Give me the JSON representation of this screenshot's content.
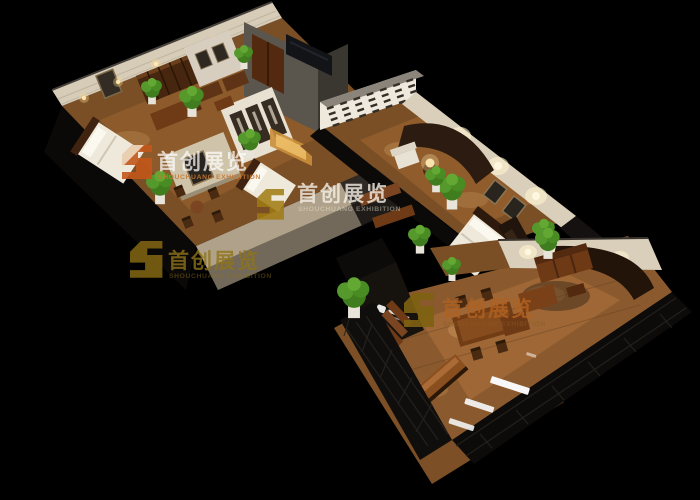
{
  "scene": {
    "type": "3d-birdseye-interior-render",
    "description": "Bird's-eye 3D rendering of a zigzag wooden furniture exhibition showroom (bedroom, study, living and dining displays) floating on a black background",
    "background_color": "#000000",
    "palette": {
      "floor_wood": "#8a5a2e",
      "floor_wood_light": "#b87840",
      "wall_cream": "#d9cfba",
      "wall_taupe": "#b0a28a",
      "wall_gray": "#57524b",
      "wall_dark": "#16120e",
      "lattice_black": "#0d0b0a",
      "furniture_brown": "#6e3a16",
      "bedding_white": "#efe9dc",
      "plant_green": "#4a8c24",
      "light_warm": "#ffd98a",
      "sign_white": "#f5f5f5"
    },
    "rooms": [
      {
        "name": "bedroom-study-suite",
        "position": "top-left",
        "furnishings": [
          "double-bed",
          "bookcase",
          "writing-desk",
          "armchairs",
          "tea-table",
          "wardrobe-niche-display",
          "second-bed",
          "potted-plants",
          "framed-art",
          "wall-sconces"
        ]
      },
      {
        "name": "living-bedroom-suite",
        "position": "center",
        "furnishings": [
          "drawer-display-wall",
          "curved-feature-wall",
          "white-armchair",
          "table-lamp",
          "wood-benches",
          "double-bed",
          "media-wall",
          "framed-art",
          "potted-plants"
        ]
      },
      {
        "name": "dining-living-showroom",
        "position": "bottom-right",
        "furnishings": [
          "brand-sign-wall",
          "step-shelves",
          "dining-table",
          "high-back-chairs",
          "long-counter",
          "sofa-set",
          "chaise",
          "armchair",
          "potted-plants",
          "lattice-fascia-signs"
        ]
      }
    ]
  },
  "watermarks": {
    "cn": "首创展览",
    "en": "SHOUCHUANG EXHIBITION",
    "count": 4,
    "instances": [
      {
        "position": "upper-left",
        "logo_color": "#c2571b",
        "text_color": "#ffffff"
      },
      {
        "position": "mid-left",
        "logo_color": "#7d6212",
        "text_color": "#8f7318"
      },
      {
        "position": "center",
        "logo_color": "#a07a10",
        "text_color": "#f5f0e6"
      },
      {
        "position": "lower-center",
        "logo_color": "#7d6212",
        "text_color": "#b06020"
      }
    ]
  }
}
